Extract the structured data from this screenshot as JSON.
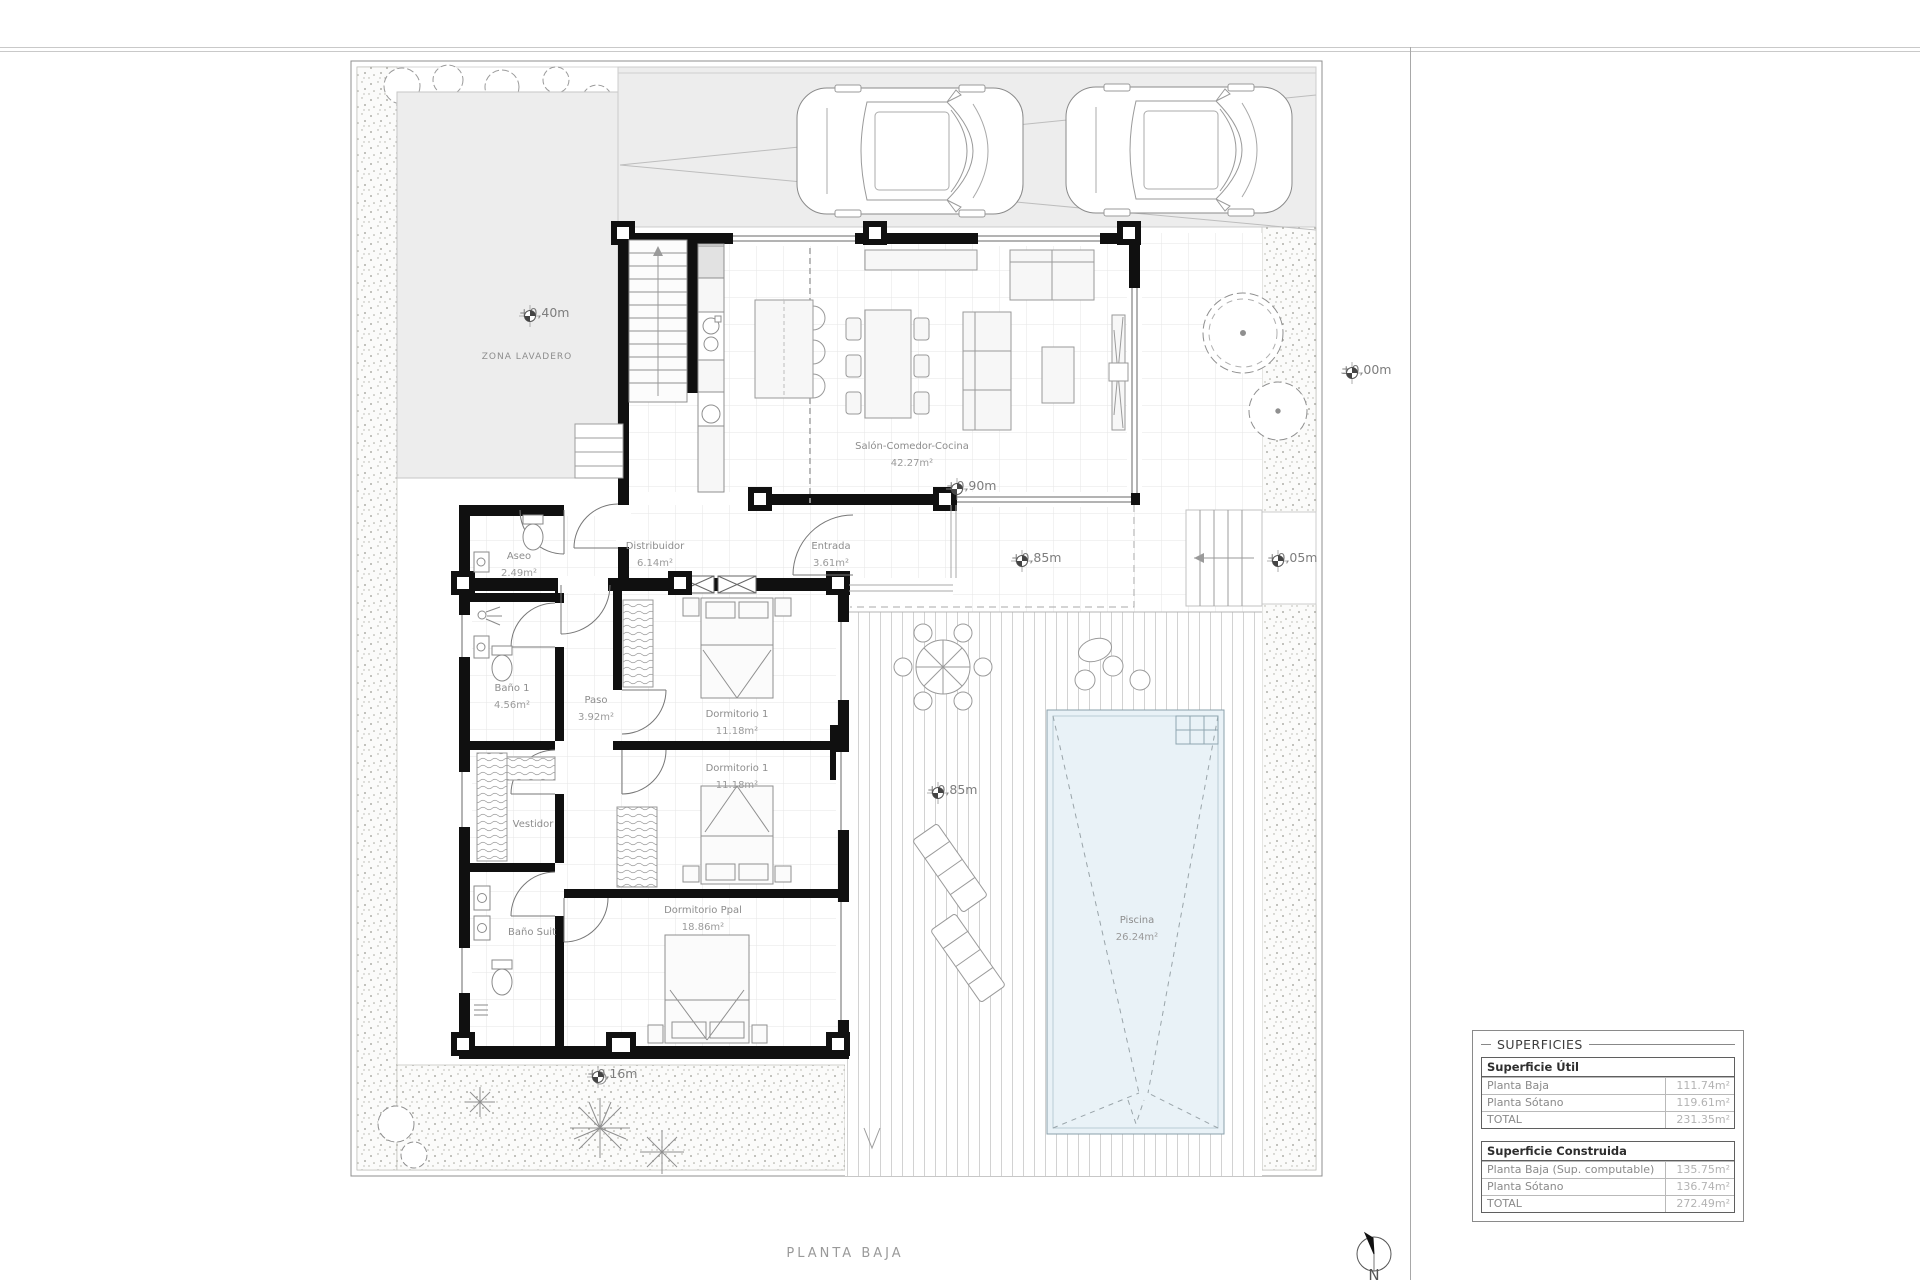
{
  "title": "PLANTA BAJA",
  "north_label": "N",
  "rooms": {
    "salon": {
      "name": "Salón-Comedor-Cocina",
      "area": "42.27m²"
    },
    "distribuidor": {
      "name": "Distribuidor",
      "area": "6.14m²"
    },
    "entrada": {
      "name": "Entrada",
      "area": "3.61m²"
    },
    "aseo": {
      "name": "Aseo",
      "area": "2.49m²"
    },
    "bano1": {
      "name": "Baño 1",
      "area": "4.56m²"
    },
    "paso": {
      "name": "Paso",
      "area": "3.92m²"
    },
    "vestidor": {
      "name": "Vestidor"
    },
    "bano_suit": {
      "name": "Baño Suit"
    },
    "dormitorio1": {
      "name": "Dormitorio 1",
      "area": "11.18m²"
    },
    "dormitorio2": {
      "name": "Dormitorio 1",
      "area": "11.18m²"
    },
    "dormitorio_ppal": {
      "name": "Dormitorio Ppal",
      "area": "18.86m²"
    },
    "piscina": {
      "name": "Piscina",
      "area": "26.24m²"
    },
    "zona_lavadero": {
      "name": "ZONA LAVADERO"
    }
  },
  "levels": {
    "lavadero": "+0,40m",
    "exterior": "±0,00m",
    "salon": "+0,90m",
    "terraza": "+0,85m",
    "acceso": "+0,05m",
    "deck": "+0,85m",
    "jardin": "+0,16m"
  },
  "surfaces_table": {
    "title": "SUPERFICIES",
    "util": {
      "header": "Superficie Útil",
      "rows": [
        [
          "Planta Baja",
          "111.74m²"
        ],
        [
          "Planta Sótano",
          "119.61m²"
        ],
        [
          "TOTAL",
          "231.35m²"
        ]
      ]
    },
    "construida": {
      "header": "Superficie Construida",
      "rows": [
        [
          "Planta Baja (Sup. computable)",
          "135.75m²"
        ],
        [
          "Planta Sótano",
          "136.74m²"
        ],
        [
          "TOTAL",
          "272.49m²"
        ]
      ]
    }
  }
}
